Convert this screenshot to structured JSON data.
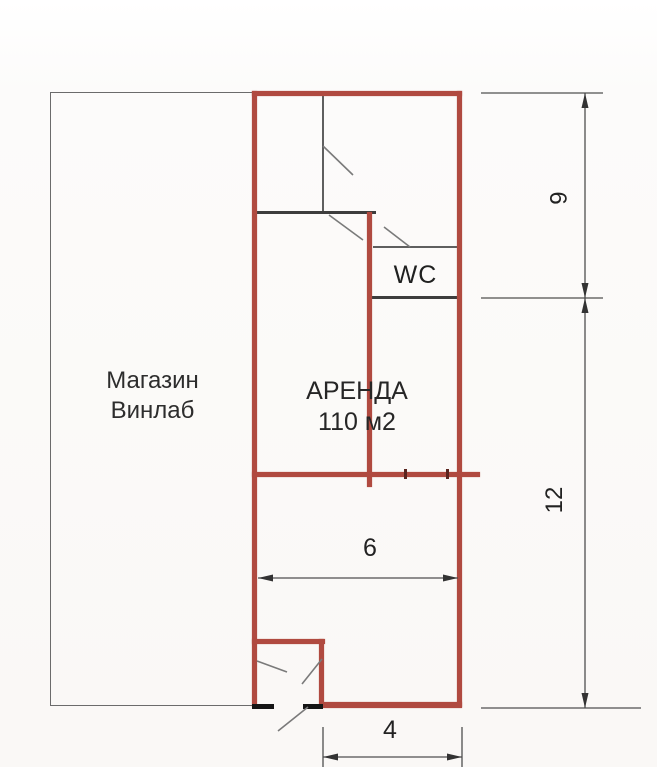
{
  "plan": {
    "title": "floor-plan",
    "accent_red": "#b04a40",
    "wall_color": "#5f5f5f",
    "rooms": {
      "store": {
        "line1": "Магазин",
        "line2": "Винлаб"
      },
      "rental": {
        "line1": "АРЕНДА",
        "line2": "110 м2"
      },
      "wc": {
        "label": "WC"
      }
    },
    "dimensions": {
      "upper_height": "6",
      "lower_height": "12",
      "room_width": "6",
      "entrance_width": "4"
    }
  }
}
